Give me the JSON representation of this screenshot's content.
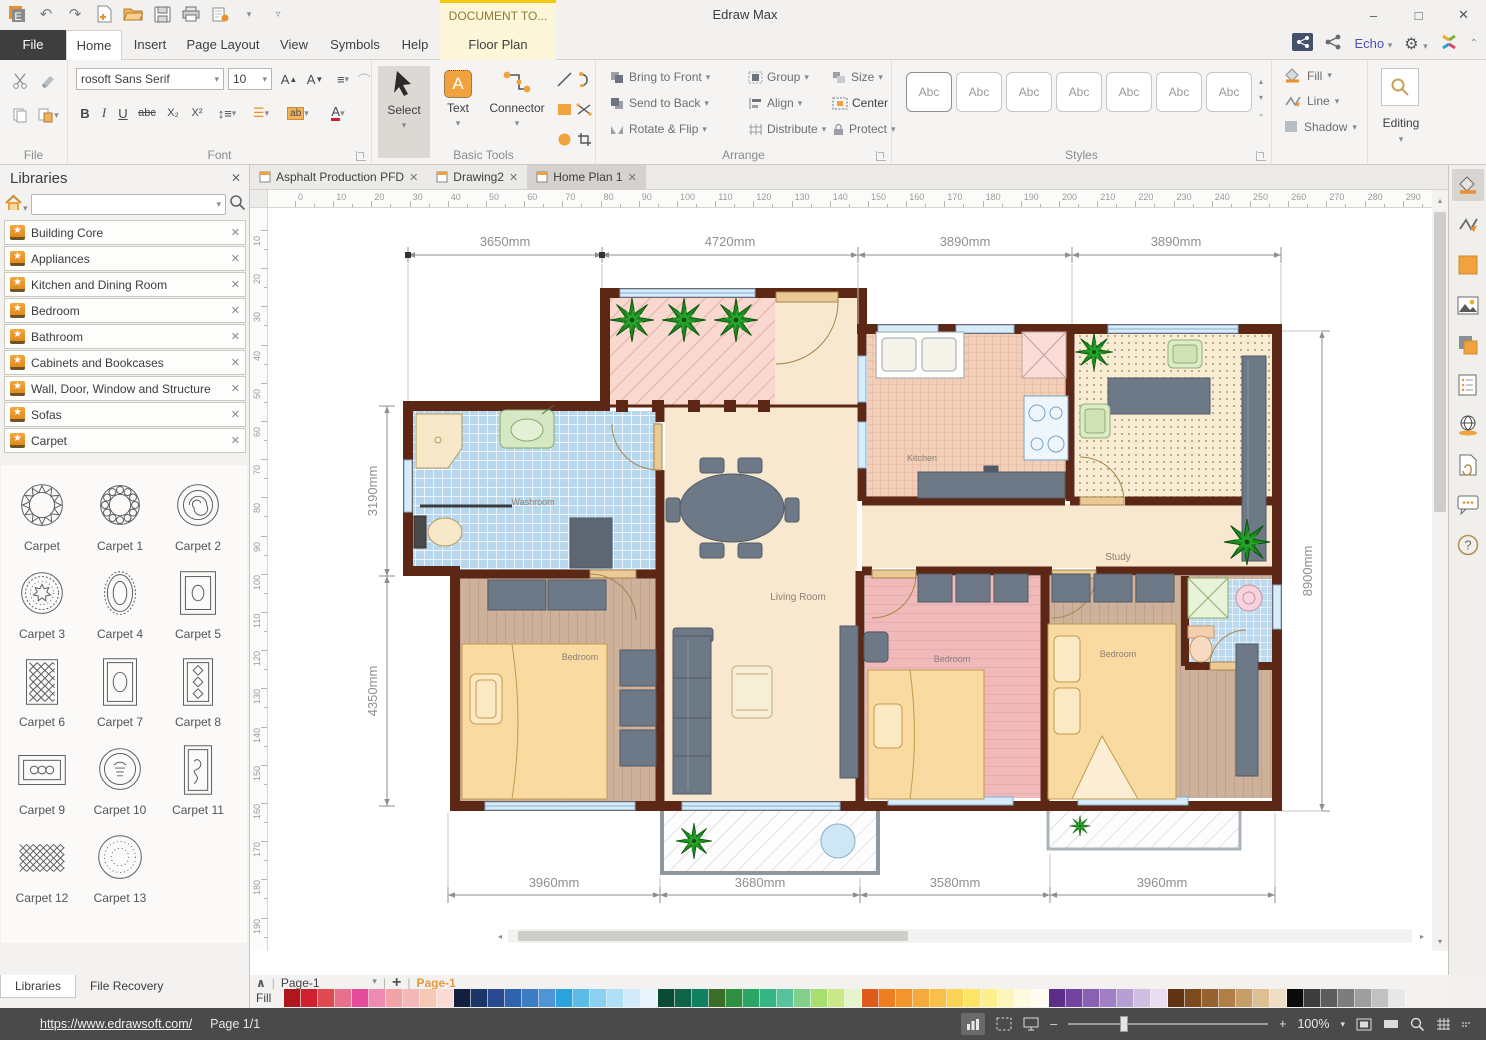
{
  "icons": {
    "close": "✕",
    "dropdown": "▾",
    "up": "▴",
    "star": "★",
    "plus": "+",
    "minus": "–",
    "maximize": "□",
    "undo": "↶",
    "redo": "↷",
    "chevron_up": "⌃",
    "left": "◂",
    "right": "▸"
  },
  "window": {
    "title": "Edraw Max"
  },
  "contextual": {
    "header": "DOCUMENT TO...",
    "tab": "Floor Plan"
  },
  "menu": {
    "file": "File",
    "tabs": [
      "Home",
      "Insert",
      "Page Layout",
      "View",
      "Symbols",
      "Help"
    ]
  },
  "account": {
    "user": "Echo"
  },
  "ribbon": {
    "groups": {
      "file": "File",
      "font": "Font",
      "basic": "Basic Tools",
      "arrange": "Arrange",
      "styles": "Styles"
    },
    "font": {
      "family": "rosoft Sans Serif",
      "size": "10",
      "bold": "B",
      "italic": "I",
      "underline": "U",
      "strike": "abc",
      "subscript": "X₂",
      "superscript": "X²",
      "highlight": "ab",
      "color": "A"
    },
    "basic": {
      "select": "Select",
      "text": "Text",
      "connector": "Connector",
      "text_glyph": "A"
    },
    "arrange": {
      "col1": [
        "Bring to Front",
        "Send to Back",
        "Rotate & Flip"
      ],
      "col2": [
        "Group",
        "Align",
        "Distribute"
      ],
      "col3": [
        "Size",
        "Center",
        "Protect"
      ]
    },
    "styles": {
      "sample": "Abc"
    },
    "effects": {
      "fill": "Fill",
      "line": "Line",
      "shadow": "Shadow"
    },
    "editing": "Editing"
  },
  "libraries": {
    "title": "Libraries",
    "groups": [
      "Building Core",
      "Appliances",
      "Kitchen and Dining Room",
      "Bedroom",
      "Bathroom",
      "Cabinets and Bookcases",
      "Wall, Door, Window and Structure",
      "Sofas",
      "Carpet"
    ],
    "carpets": [
      {
        "name": "Carpet",
        "shape": "circle_star"
      },
      {
        "name": "Carpet 1",
        "shape": "circle_flower"
      },
      {
        "name": "Carpet 2",
        "shape": "circle_rose"
      },
      {
        "name": "Carpet 3",
        "shape": "circle_dot"
      },
      {
        "name": "Carpet 4",
        "shape": "oval"
      },
      {
        "name": "Carpet 5",
        "shape": "rect_oval_sm"
      },
      {
        "name": "Carpet 6",
        "shape": "rect_lattice"
      },
      {
        "name": "Carpet 7",
        "shape": "rect_oval"
      },
      {
        "name": "Carpet 8",
        "shape": "rect_diamonds"
      },
      {
        "name": "Carpet 9",
        "shape": "rect_wide"
      },
      {
        "name": "Carpet 10",
        "shape": "circle_figure"
      },
      {
        "name": "Carpet 11",
        "shape": "rect_tall"
      },
      {
        "name": "Carpet 12",
        "shape": "lattice_wide"
      },
      {
        "name": "Carpet 13",
        "shape": "circle_dotted"
      }
    ],
    "tabs": [
      "Libraries",
      "File Recovery"
    ]
  },
  "documents": {
    "tabs": [
      {
        "label": "Asphalt Production PFD"
      },
      {
        "label": "Drawing2"
      },
      {
        "label": "Home Plan 1"
      }
    ]
  },
  "ruler": {
    "horizontal": [
      0,
      10,
      20,
      30,
      40,
      50,
      60,
      70,
      80,
      90,
      100,
      110,
      120,
      130,
      140,
      150,
      160,
      170,
      180,
      190,
      200,
      210,
      220,
      230,
      240,
      250,
      260,
      270,
      280,
      290
    ],
    "vertical": [
      10,
      20,
      30,
      40,
      50,
      60,
      70,
      80,
      90,
      100,
      110,
      120,
      130,
      140,
      150,
      160,
      170,
      180,
      190
    ]
  },
  "floor_plan": {
    "rooms": {
      "washroom": "Washroom",
      "kitchen": "Kitchen",
      "study": "Study",
      "living": "Living Room",
      "bedroom": "Bedroom"
    },
    "dims": {
      "top": [
        "3650mm",
        "4720mm",
        "3890mm",
        "3890mm"
      ],
      "bottom": [
        "3960mm",
        "3680mm",
        "3580mm",
        "3960mm"
      ],
      "left": [
        "3190mm",
        "4350mm"
      ],
      "right": "8900mm"
    }
  },
  "pagebar": {
    "page_select": "Page-1",
    "active_page": "Page-1",
    "fill": "Fill",
    "palette": [
      "#b1161c",
      "#d02030",
      "#dd4a52",
      "#e8708c",
      "#e54b9b",
      "#ef8ab2",
      "#f2a3a6",
      "#f5b8b8",
      "#f7c9b4",
      "#fadbd6",
      "#11203f",
      "#1c3567",
      "#27498f",
      "#2f63ad",
      "#3b7cc2",
      "#4f94d5",
      "#2aa2dc",
      "#5cbce8",
      "#8cd0f1",
      "#b0dff6",
      "#d2ecfa",
      "#e9f6fd",
      "#0b4a34",
      "#0f6347",
      "#118060",
      "#3a6e27",
      "#2e9040",
      "#2aa565",
      "#35b584",
      "#57c29c",
      "#82d089",
      "#a8dd70",
      "#cbe98b",
      "#e6f4cd",
      "#e05a1d",
      "#ee7e22",
      "#f2952c",
      "#f5aa3c",
      "#f8bf49",
      "#fad355",
      "#fce464",
      "#fdf08c",
      "#fdf6bb",
      "#fefae0",
      "#fffdf2",
      "#5c2e87",
      "#71459f",
      "#8a60b3",
      "#a07fc4",
      "#b89fd3",
      "#d0bfe3",
      "#e8ddf1",
      "#5f3313",
      "#7c4a1c",
      "#96622f",
      "#b07f48",
      "#c79e69",
      "#dcc094",
      "#eedfc4",
      "#0a0a0a",
      "#3d3d3d",
      "#5c5c5c",
      "#7d7d7d",
      "#9e9e9e",
      "#c2c2c2",
      "#e8e8e8"
    ]
  },
  "status": {
    "url": "https://www.edrawsoft.com/",
    "page": "Page 1/1",
    "zoom": "100%"
  }
}
